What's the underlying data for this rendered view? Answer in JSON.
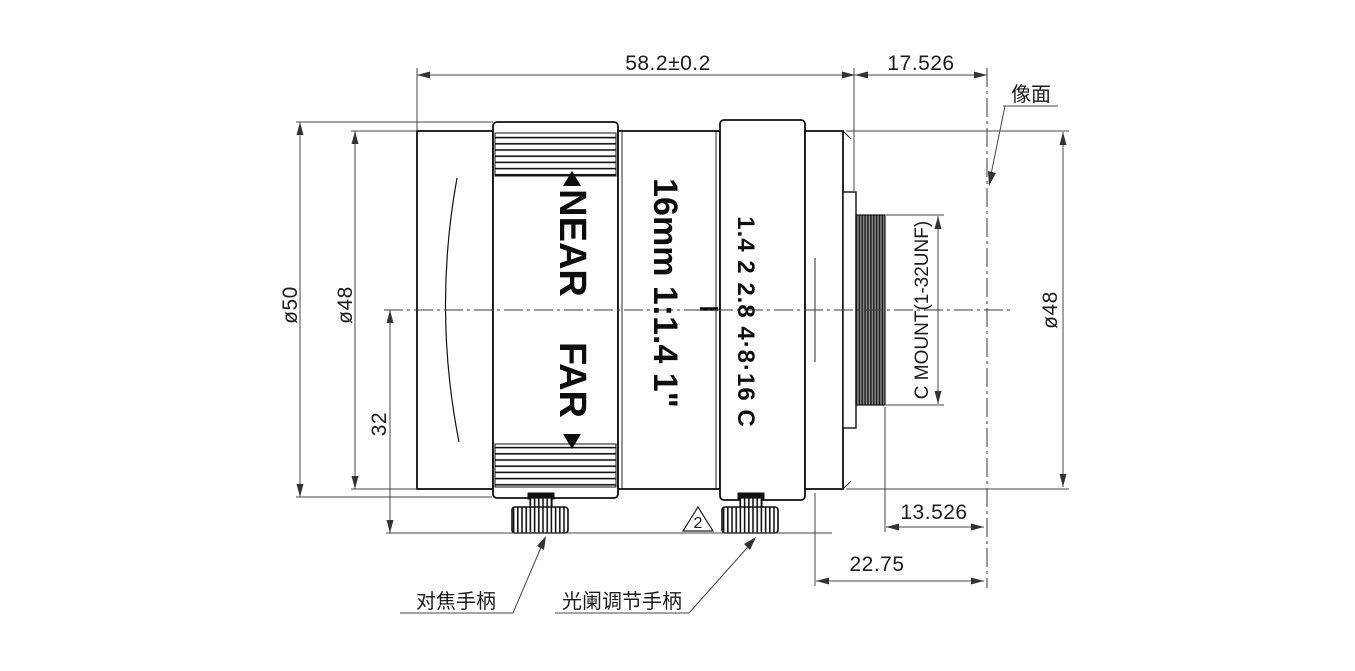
{
  "drawing": {
    "dimensions": {
      "overall_length": "58.2±0.2",
      "flange_focal_distance": "17.526",
      "front_outer_diameter": "ø50",
      "front_ring_diameter": "ø48",
      "handle_drop": "32",
      "rear_diameter": "ø48",
      "thread_end_to_image": "13.526",
      "shoulder_to_image": "22.75",
      "mount_thread": "C MOUNT(1-32UNF)"
    },
    "labels": {
      "image_plane": "像面",
      "focus_handle": "对焦手柄",
      "aperture_handle": "光阑调节手柄",
      "revision_mark": "2"
    },
    "lens_markings": {
      "near": "NEAR",
      "far": "FAR",
      "spec": "16mm 1:1.4 1\"",
      "aperture_scale": "1.4 2 2.8 4·8·16 C"
    },
    "colors": {
      "outline": "#111111",
      "dimension_line": "#474747",
      "background": "#ffffff"
    }
  }
}
